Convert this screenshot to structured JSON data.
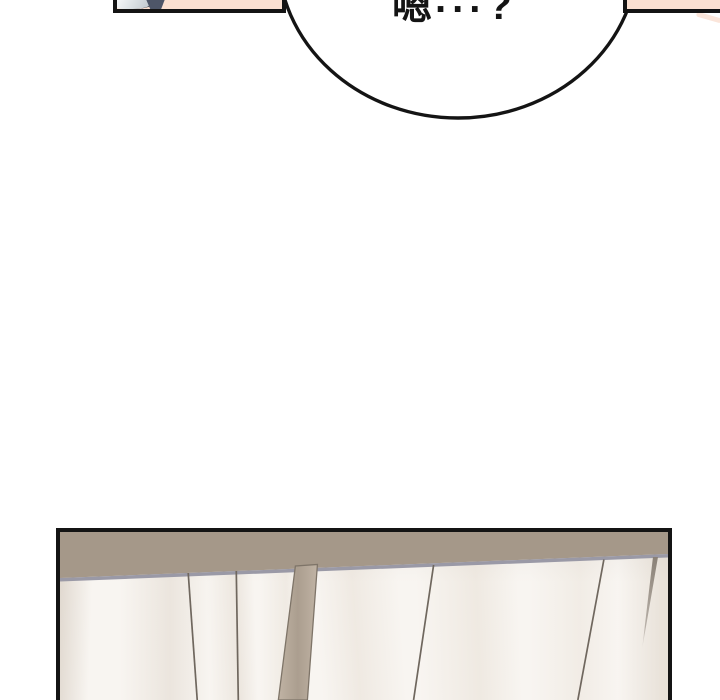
{
  "bubble": {
    "full_text": "嗯...?",
    "char": "嗯",
    "dots": "...",
    "question_mark": "?"
  },
  "theme": {
    "bg": "#ffffff",
    "ink": "#141414",
    "bubble-fill": "#ffffff",
    "skin": "#fbe0d1",
    "collar": "#4e5668",
    "ceiling": "#a59889",
    "ceiling-edge": "#9a99a6",
    "blind-base": "#f8f5f1",
    "line": "#6f675e",
    "slat-a": "#c0b3a4",
    "slat-b": "#ab9e8f",
    "slat-edge": "#7e7468",
    "sliver": "#8a8177"
  }
}
